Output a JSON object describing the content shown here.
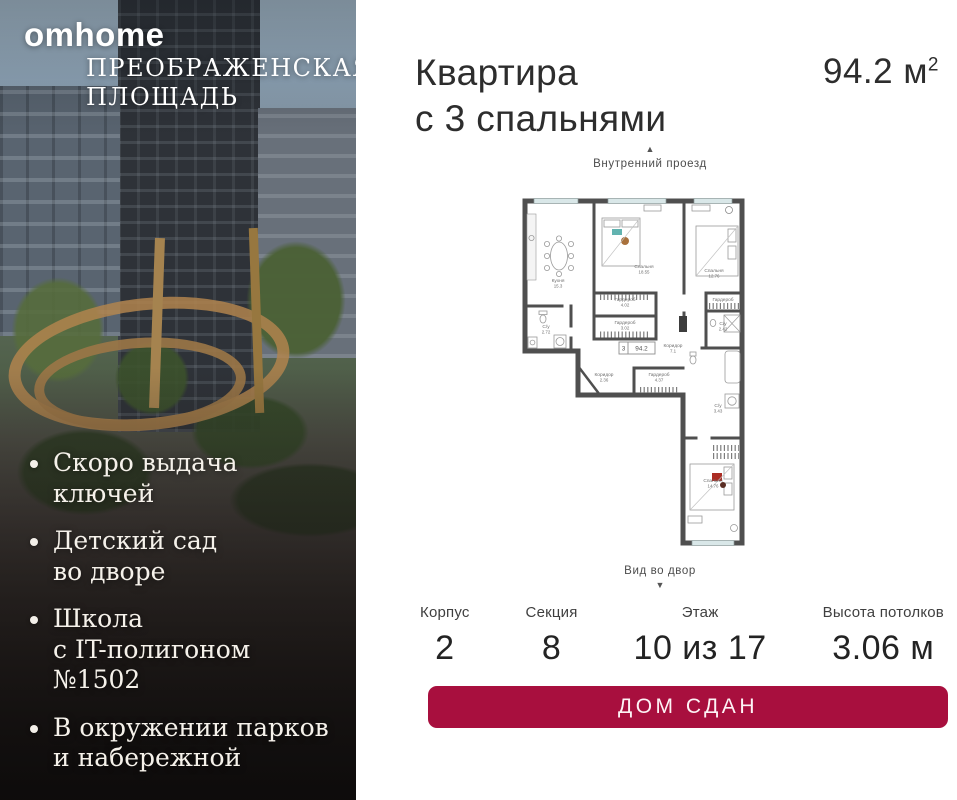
{
  "brand": {
    "logo": "omhome",
    "project_line1": "ПРЕОБРАЖЕНСКАЯ",
    "project_line2": "ПЛОЩАДЬ"
  },
  "features": [
    {
      "lines": [
        "Скоро выдача",
        "ключей"
      ]
    },
    {
      "lines": [
        "Детский сад",
        "во дворе"
      ]
    },
    {
      "lines": [
        "Школа",
        "с IT-полигоном",
        "№1502"
      ]
    },
    {
      "lines": [
        "В окружении парков",
        "и набережной"
      ]
    }
  ],
  "header": {
    "title_line1": "Квартира",
    "title_line2": "с 3 спальнями",
    "area_value": "94.2",
    "area_unit": "м",
    "area_sup": "2"
  },
  "floorplan": {
    "top_label": "Внутренний проезд",
    "bottom_label": "Вид во двор",
    "arrow_up": "▲",
    "arrow_down": "▼",
    "badge": {
      "rooms": "3",
      "area": "94.2"
    },
    "rooms": [
      {
        "name": "Кухня",
        "area": "15.3",
        "x": 42,
        "y": 84
      },
      {
        "name": "Спальня",
        "area": "18.55",
        "x": 128,
        "y": 70
      },
      {
        "name": "Спальня",
        "area": "12.76",
        "x": 198,
        "y": 74
      },
      {
        "name": "Гардероб",
        "area": "4.02",
        "x": 109,
        "y": 103
      },
      {
        "name": "Гардероб",
        "area": "3.02",
        "x": 109,
        "y": 126
      },
      {
        "name": "С/у",
        "area": "2.72",
        "x": 30,
        "y": 130
      },
      {
        "name": "Коридор",
        "area": "2.36",
        "x": 88,
        "y": 178
      },
      {
        "name": "Гардероб",
        "area": "4.37",
        "x": 143,
        "y": 178
      },
      {
        "name": "Коридор",
        "area": "7.1",
        "x": 157,
        "y": 149
      },
      {
        "name": "Гардероб",
        "area": "",
        "x": 207,
        "y": 103
      },
      {
        "name": "С/у",
        "area": "2.42",
        "x": 207,
        "y": 127
      },
      {
        "name": "С/у",
        "area": "3.43",
        "x": 202,
        "y": 209
      },
      {
        "name": "Спальня",
        "area": "14.76",
        "x": 197,
        "y": 284
      }
    ]
  },
  "details": [
    {
      "label": "Корпус",
      "value": "2"
    },
    {
      "label": "Секция",
      "value": "8"
    },
    {
      "label": "Этаж",
      "value": "10 из 17"
    },
    {
      "label": "Высота потолков",
      "value": "3.06 м"
    }
  ],
  "cta": {
    "label": "ДОМ СДАН",
    "color": "#a80f3e"
  }
}
